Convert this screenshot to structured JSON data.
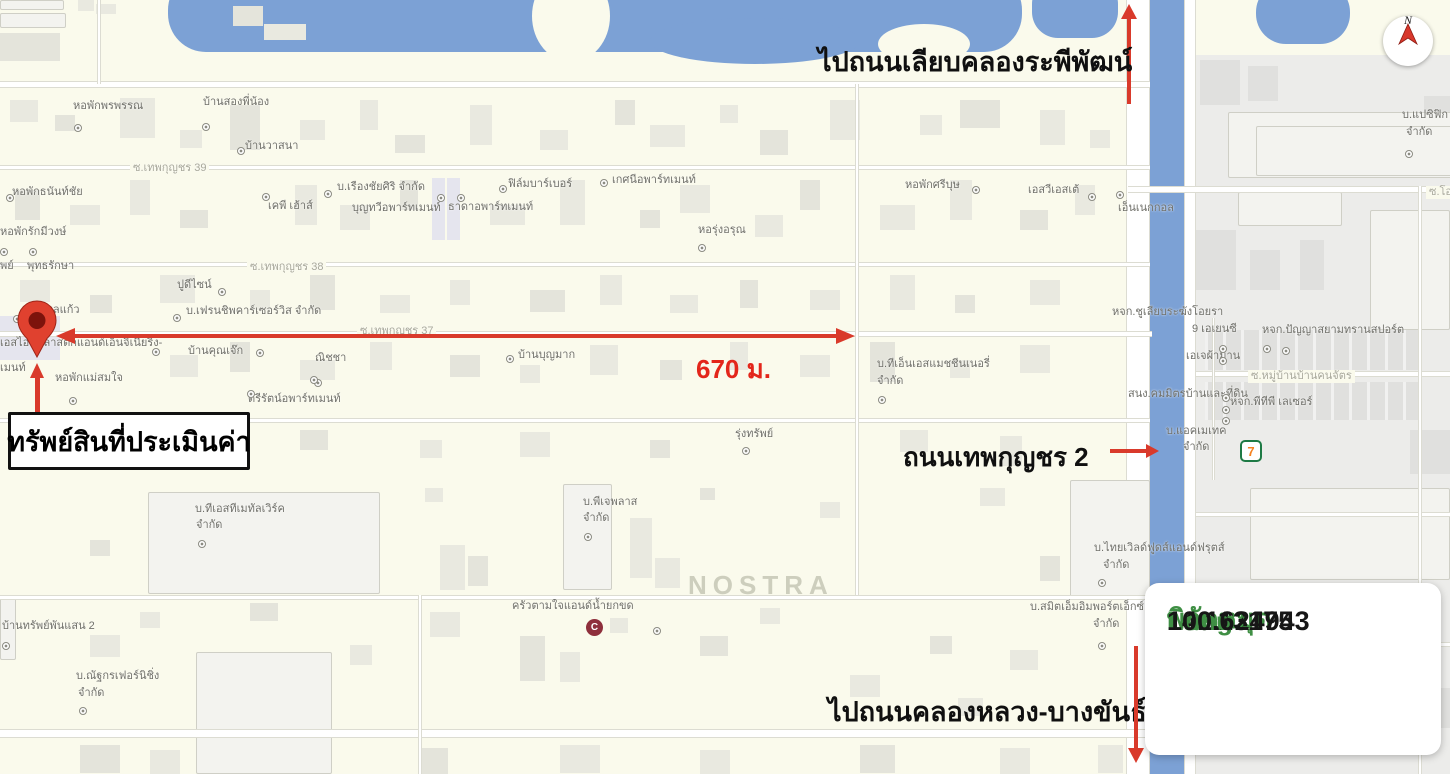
{
  "annotations": {
    "to_top_road": "ไปถนนเลียบคลองระพีพัฒน์",
    "to_bottom_road": "ไปถนนคลองหลวง-บางขันธ์",
    "side_road": "ถนนเทพกุญชร 2",
    "property": "ทรัพย์สินที่ประเมินค่า",
    "distance": "670 ม.",
    "watermark": "NOSTRA",
    "compass_letter": "N",
    "seven_eleven": "7",
    "shop_logo_glyph": "C"
  },
  "coords_box": {
    "title": "พิกัดหมุด",
    "lat_label": "Lat :",
    "lat_value": "14.113175",
    "long_label": "Long :",
    "long_value": "100.624943"
  },
  "colors": {
    "map_bg": "#FAFAEC",
    "water": "#7CA1D5",
    "annotation_red": "#D93A2B",
    "distance_red": "#E3261B",
    "coord_green": "#3F8F44",
    "grey_zone": "#ECECEA"
  },
  "map_labels": [
    {
      "t": "หอพักพรพรรณ",
      "x": 73,
      "y": 100
    },
    {
      "t": "บ้านสองพี่น้อง",
      "x": 203,
      "y": 96
    },
    {
      "t": "บ้านวาสนา",
      "x": 245,
      "y": 140
    },
    {
      "t": "ซ.เทพกุญชร 39",
      "x": 130,
      "y": 162,
      "k": "road"
    },
    {
      "t": "หอพักธนันท์ชัย",
      "x": 12,
      "y": 186
    },
    {
      "t": "เคพี เฮ้าส์",
      "x": 268,
      "y": 200
    },
    {
      "t": "บ.เรืองชัยศิริ จำกัด",
      "x": 337,
      "y": 181
    },
    {
      "t": "บุญทวีอพาร์ทเมนท์",
      "x": 352,
      "y": 202
    },
    {
      "t": "ธาดาอพาร์ทเมนท์",
      "x": 448,
      "y": 201
    },
    {
      "t": "ฟิล์มบาร์เบอร์",
      "x": 508,
      "y": 178
    },
    {
      "t": "เกศนีอพาร์ทเมนท์",
      "x": 612,
      "y": 174
    },
    {
      "t": "หอพักศรีบุษ",
      "x": 905,
      "y": 179
    },
    {
      "t": "เอสวีเอสเต้",
      "x": 1028,
      "y": 184
    },
    {
      "t": "เอ็นเนกกอล",
      "x": 1118,
      "y": 202
    },
    {
      "t": "หอพักรักมีวงษ์",
      "x": 0,
      "y": 226
    },
    {
      "t": "พย์",
      "x": 0,
      "y": 260
    },
    {
      "t": "พุทธรักษา",
      "x": 27,
      "y": 260
    },
    {
      "t": "ซ.เทพกุญชร 38",
      "x": 247,
      "y": 261,
      "k": "road"
    },
    {
      "t": "หอรุ่งอรุณ",
      "x": 698,
      "y": 224
    },
    {
      "t": "ปูดีไซน์",
      "x": 177,
      "y": 279
    },
    {
      "t": "บ้านพูลแก้ว",
      "x": 25,
      "y": 304
    },
    {
      "t": "บ.เฟรนชิพคาร์เซอร์วิส จำกัด",
      "x": 186,
      "y": 305
    },
    {
      "t": "หจก.ชูเลียบระฆังโอยรา",
      "x": 1112,
      "y": 306
    },
    {
      "t": "ซ.เทพกุญชร 37",
      "x": 357,
      "y": 325,
      "k": "road"
    },
    {
      "t": "เอสไอบีพลาสติกแอนด์เอ็นจิเนียริ่ง-",
      "x": 0,
      "y": 337
    },
    {
      "t": "บ้านคุณเจ๊ก",
      "x": 188,
      "y": 345
    },
    {
      "t": "ณิชชา",
      "x": 315,
      "y": 352
    },
    {
      "t": "บ้านบุญมาก",
      "x": 518,
      "y": 349
    },
    {
      "t": "9 เอเยนซี",
      "x": 1192,
      "y": 323
    },
    {
      "t": "หจก.ปัญญาสยามทรานสปอร์ต",
      "x": 1262,
      "y": 324
    },
    {
      "t": "เอเจผ้าม่าน",
      "x": 1186,
      "y": 350
    },
    {
      "t": "เมนท์",
      "x": 0,
      "y": 362
    },
    {
      "t": "หอพักแม่สมใจ",
      "x": 55,
      "y": 372
    },
    {
      "t": "ตรีรัตน์อพาร์ทเมนท์",
      "x": 248,
      "y": 393
    },
    {
      "t": "บ.ทีเอ็นเอสแมชชีนเนอรี่",
      "x": 877,
      "y": 358
    },
    {
      "t": "จำกัด",
      "x": 877,
      "y": 375
    },
    {
      "t": "สนง.คมมิตรบ้านและที่ดิน",
      "x": 1128,
      "y": 388
    },
    {
      "t": "ซ.หมู่บ้านบ้านคนจัตร",
      "x": 1248,
      "y": 370,
      "k": "road"
    },
    {
      "t": "หจก.พีทีพี เลเซอร์",
      "x": 1230,
      "y": 396
    },
    {
      "t": "ซ.เทพกุญชร 36",
      "x": 143,
      "y": 416,
      "k": "road"
    },
    {
      "t": "รุ่งทรัพย์",
      "x": 735,
      "y": 428
    },
    {
      "t": "บ.แอคเมเทค",
      "x": 1166,
      "y": 425
    },
    {
      "t": "จำกัด",
      "x": 1183,
      "y": 441
    },
    {
      "t": "บ.ทีเอสทีเมทัลเวิร์ค",
      "x": 195,
      "y": 503
    },
    {
      "t": "จำกัด",
      "x": 196,
      "y": 519
    },
    {
      "t": "บ.พีเจพลาส",
      "x": 583,
      "y": 496
    },
    {
      "t": "จำกัด",
      "x": 583,
      "y": 512
    },
    {
      "t": "ครัวตามใจแอนด์น้ำยกขด",
      "x": 512,
      "y": 600
    },
    {
      "t": "บ.ไทยเวิลด์ฟูดส์แอนด์ฟรุตส์",
      "x": 1094,
      "y": 542
    },
    {
      "t": "จำกัด",
      "x": 1103,
      "y": 559
    },
    {
      "t": "บ.สมิตเอ็มอิมพอร์ตเอ็กซ์",
      "x": 1030,
      "y": 601
    },
    {
      "t": "จำกัด",
      "x": 1093,
      "y": 618
    },
    {
      "t": "บ้านทรัพย์พันแสน 2",
      "x": 2,
      "y": 620
    },
    {
      "t": "บ.ณัฐกรเฟอร์นิชิ่ง",
      "x": 76,
      "y": 670
    },
    {
      "t": "จำกัด",
      "x": 78,
      "y": 687
    },
    {
      "t": "บ.แปซิฟิก",
      "x": 1402,
      "y": 109
    },
    {
      "t": "จำกัด",
      "x": 1406,
      "y": 126
    },
    {
      "t": "ซ.โอ",
      "x": 1426,
      "y": 186,
      "k": "road"
    }
  ],
  "map_dots": [
    [
      74,
      124
    ],
    [
      202,
      123
    ],
    [
      237,
      147
    ],
    [
      6,
      194
    ],
    [
      262,
      193
    ],
    [
      324,
      190
    ],
    [
      437,
      194
    ],
    [
      457,
      194
    ],
    [
      499,
      185
    ],
    [
      600,
      179
    ],
    [
      972,
      186
    ],
    [
      1088,
      193
    ],
    [
      1116,
      191
    ],
    [
      0,
      248
    ],
    [
      29,
      248
    ],
    [
      218,
      288
    ],
    [
      698,
      244
    ],
    [
      13,
      315
    ],
    [
      173,
      314
    ],
    [
      152,
      348
    ],
    [
      256,
      349
    ],
    [
      314,
      379
    ],
    [
      506,
      355
    ],
    [
      310,
      376
    ],
    [
      247,
      390
    ],
    [
      69,
      397
    ],
    [
      878,
      396
    ],
    [
      742,
      447
    ],
    [
      1263,
      345
    ],
    [
      1282,
      347
    ],
    [
      1219,
      345
    ],
    [
      1219,
      357
    ],
    [
      1222,
      394
    ],
    [
      1222,
      406
    ],
    [
      1222,
      417
    ],
    [
      198,
      540
    ],
    [
      584,
      533
    ],
    [
      653,
      627
    ],
    [
      1098,
      579
    ],
    [
      1098,
      642
    ],
    [
      2,
      642
    ],
    [
      79,
      707
    ],
    [
      1405,
      150
    ]
  ]
}
